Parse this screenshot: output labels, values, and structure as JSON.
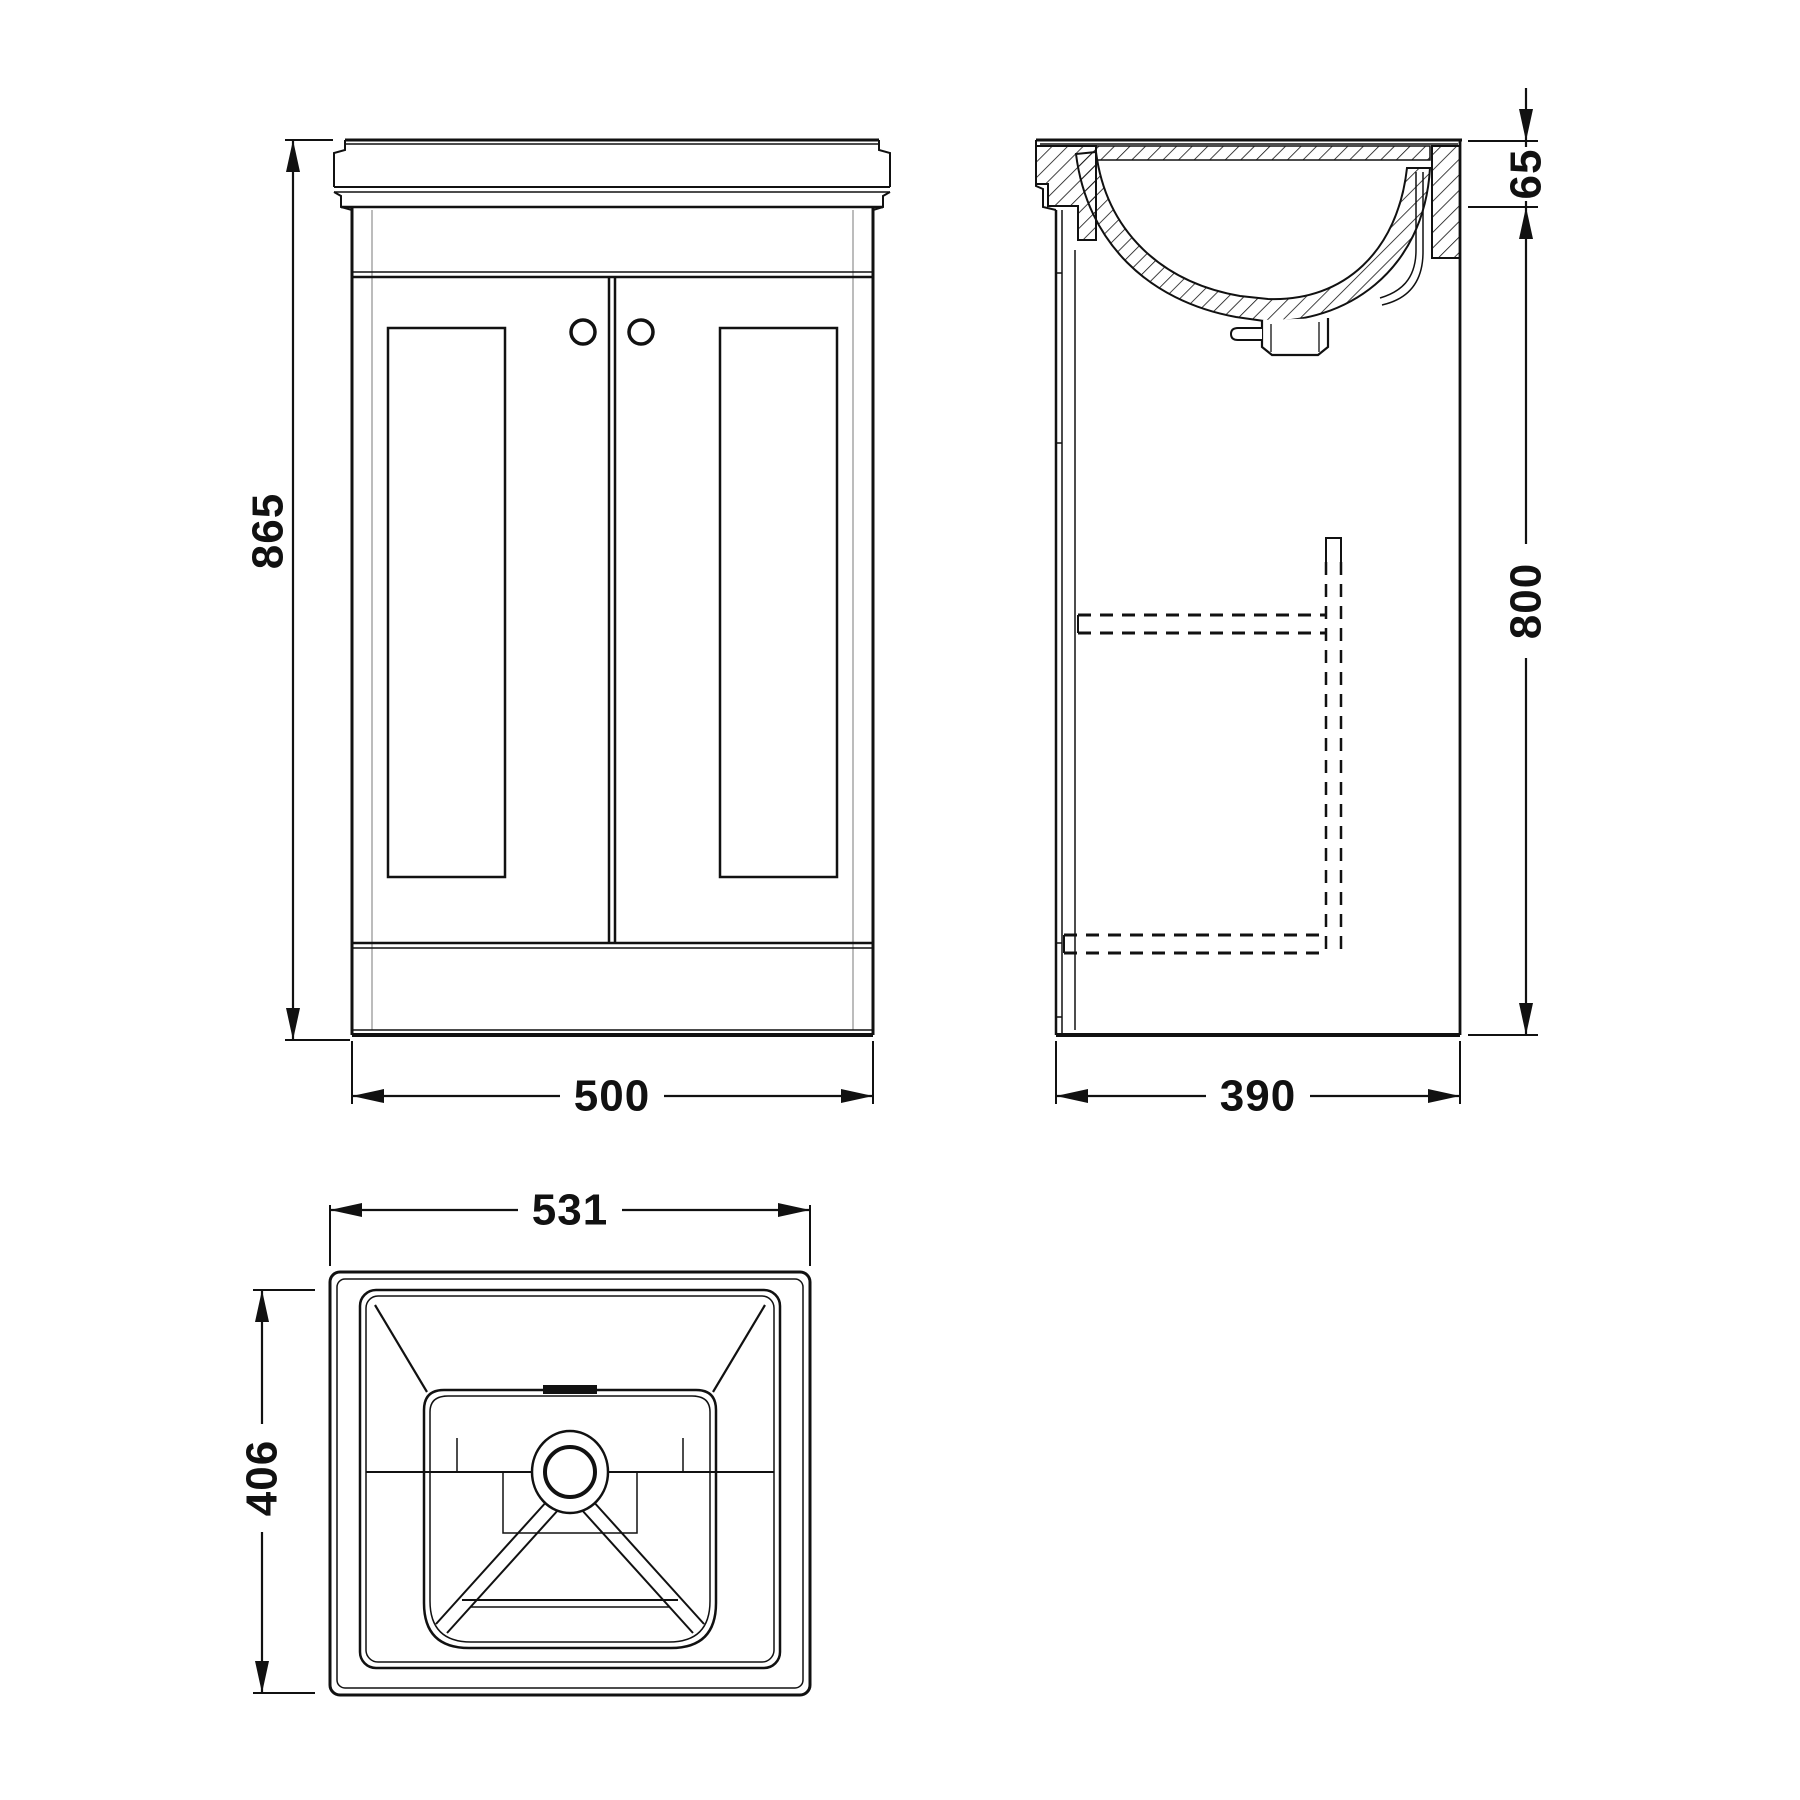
{
  "drawing": {
    "background": "#ffffff",
    "line_color": "#111111",
    "light_line_color": "#a6a6a6",
    "dimensions": {
      "front_height": "865",
      "front_width": "500",
      "side_basin_height": "65",
      "side_cabinet_height": "800",
      "side_depth": "390",
      "plan_width": "531",
      "plan_depth": "406"
    }
  }
}
